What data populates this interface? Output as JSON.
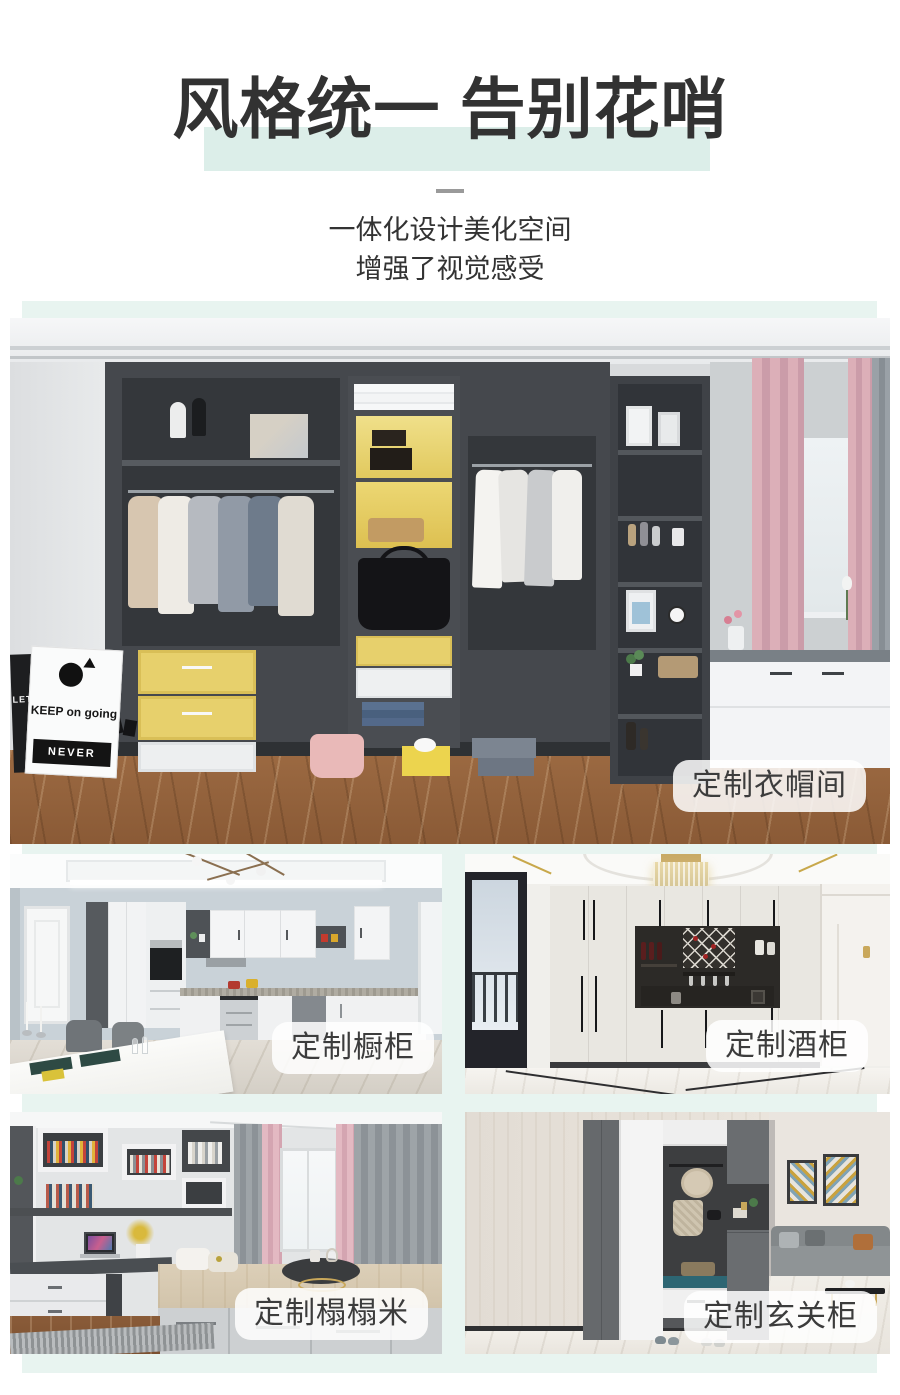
{
  "header": {
    "title": "风格统一 告别花哨",
    "subtitle_line1": "一体化设计美化空间",
    "subtitle_line2": "增强了视觉感受"
  },
  "sections": [
    {
      "label": "定制衣帽间"
    },
    {
      "label": "定制橱柜"
    },
    {
      "label": "定制酒柜"
    },
    {
      "label": "定制榻榻米"
    },
    {
      "label": "定制玄关柜"
    }
  ],
  "scenes": {
    "cloakroom": {
      "art_text_primary": "KEEP on going",
      "art_text_secondary": "NEVER",
      "art_text_side": "LET BUI"
    }
  },
  "colors": {
    "mint_background": "#e8f4f0",
    "title_highlight": "#dceee9",
    "title_text": "#323232",
    "badge_background": "rgba(255,255,255,0.85)",
    "badge_text": "#3c3c3c",
    "accent_yellow": "#e7d06c",
    "curtain_pink": "#dcafb8",
    "wardrobe_gray": "#45484d",
    "floor_wood": "#9c6a42"
  }
}
